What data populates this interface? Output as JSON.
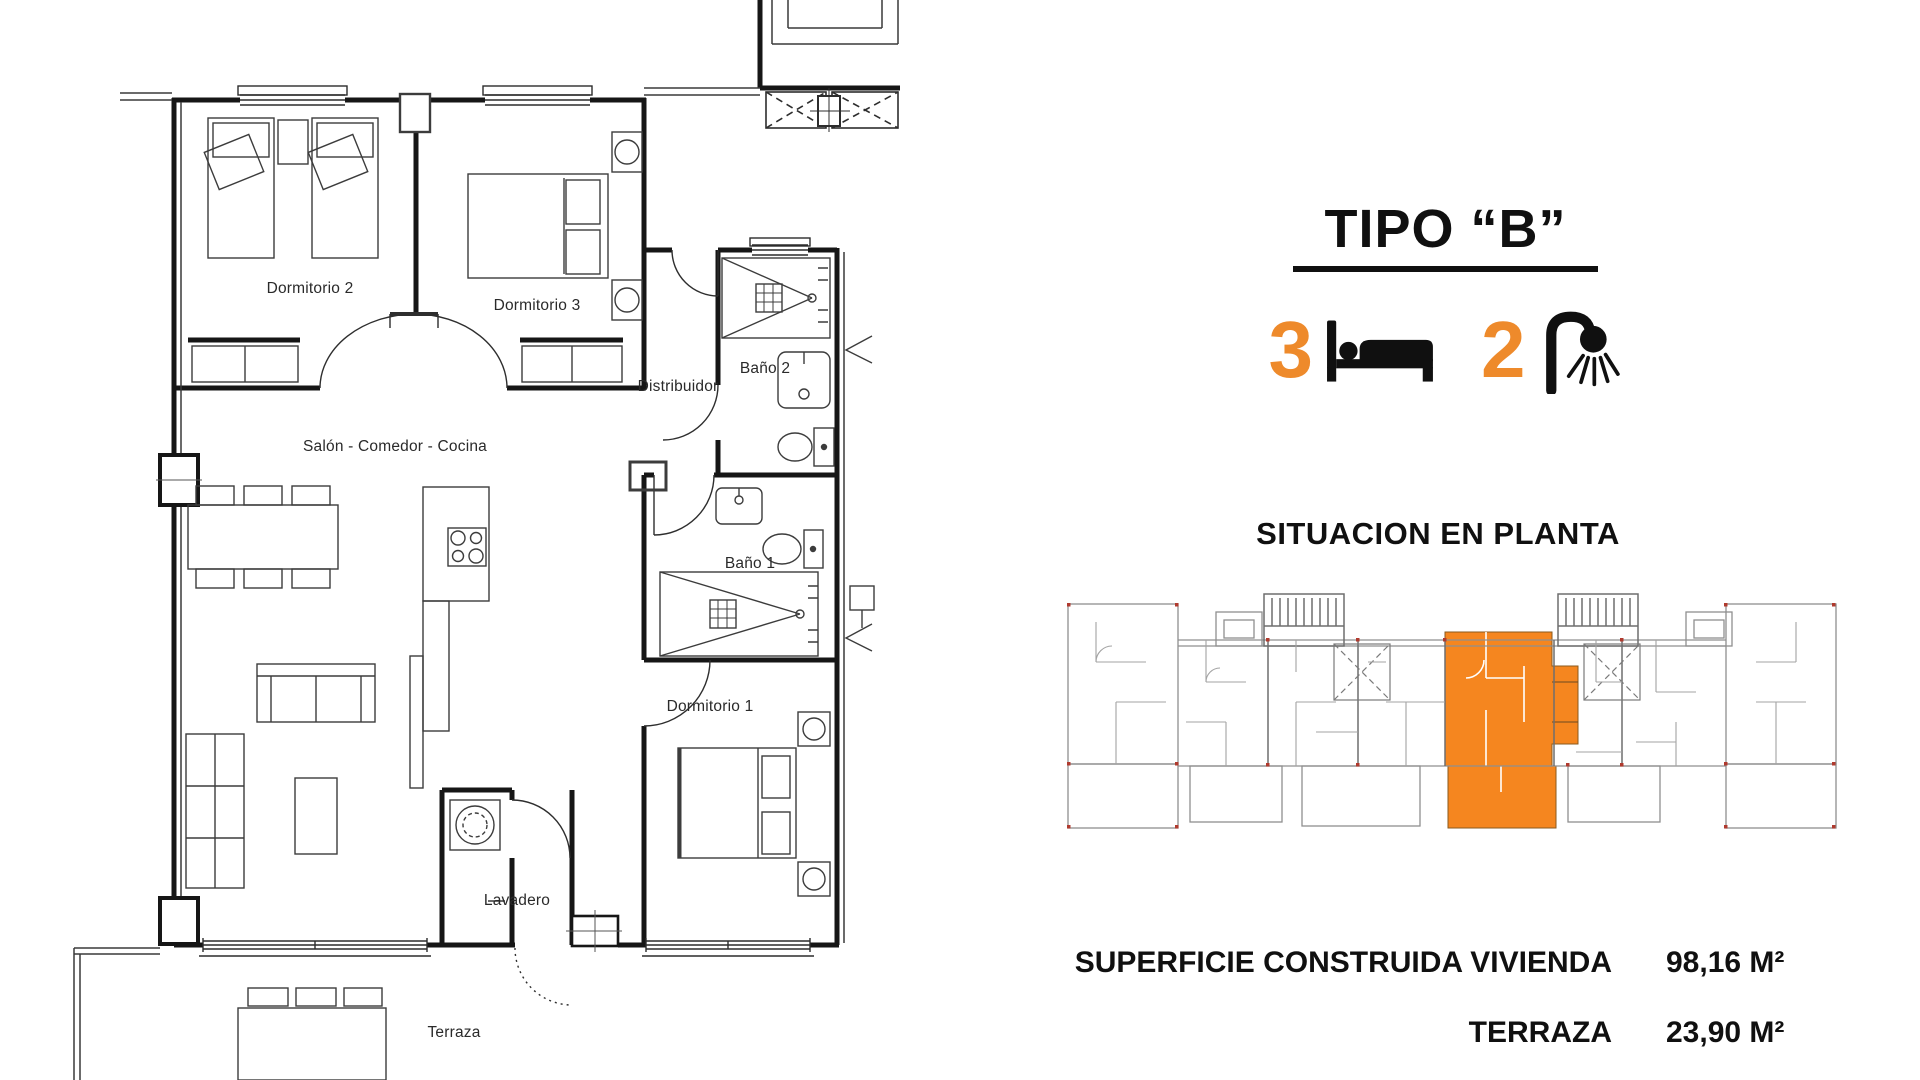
{
  "accent": "#EE8A2B",
  "site_accent": "#F5861F",
  "floor_plan": {
    "rooms": [
      {
        "id": "dormitorio-2",
        "label": "Dormitorio 2"
      },
      {
        "id": "dormitorio-3",
        "label": "Dormitorio 3"
      },
      {
        "id": "bano-2",
        "label": "Baño 2"
      },
      {
        "id": "distribuidor",
        "label": "Distribuidor"
      },
      {
        "id": "salon",
        "label": "Salón - Comedor - Cocina"
      },
      {
        "id": "bano-1",
        "label": "Baño 1"
      },
      {
        "id": "dormitorio-1",
        "label": "Dormitorio 1"
      },
      {
        "id": "lavadero",
        "label": "Lavadero"
      },
      {
        "id": "terraza",
        "label": "Terraza"
      }
    ]
  },
  "panel": {
    "title": "TIPO “B”",
    "bedrooms_count": "3",
    "bathrooms_count": "2",
    "situation_heading": "SITUACION EN PLANTA",
    "stats": [
      {
        "label": "SUPERFICIE CONSTRUIDA VIVIENDA",
        "value": "98,16 M²"
      },
      {
        "label": "TERRAZA",
        "value": "23,90 M²"
      }
    ]
  }
}
